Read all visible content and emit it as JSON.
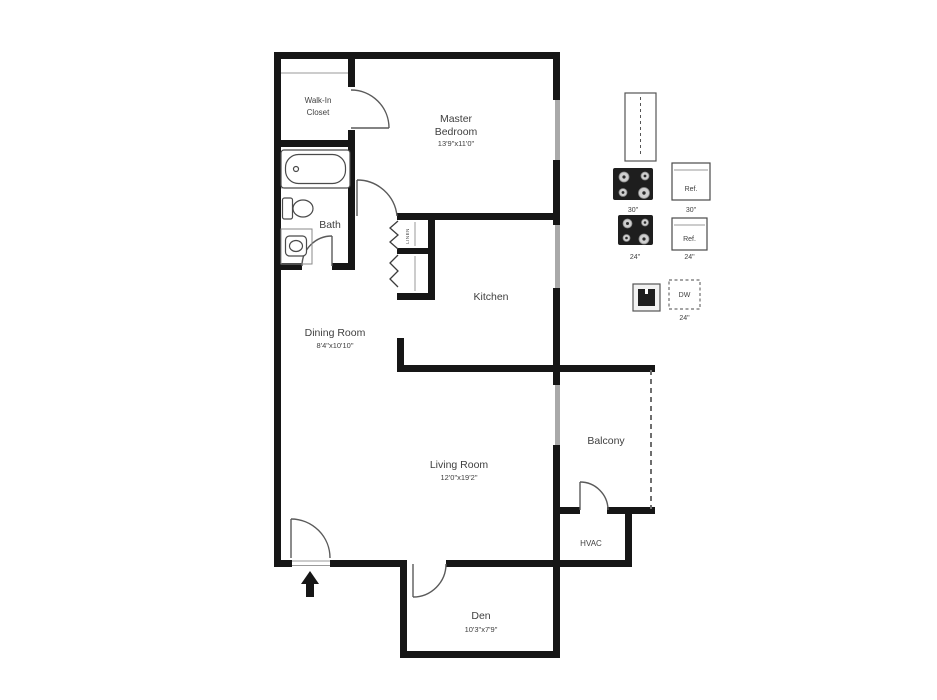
{
  "colors": {
    "wall": "#161616",
    "window": "#a9a9a9",
    "door": "#5a5a5a",
    "fixture": "#4a4a4a",
    "text": "#3f3f3f",
    "appliance_dark": "#1e1e1e",
    "dashed": "#6e6e6e"
  },
  "rooms": {
    "walk_in_closet": {
      "label_line1": "Walk-In",
      "label_line2": "Closet"
    },
    "master_bedroom": {
      "label_line1": "Master",
      "label_line2": "Bedroom",
      "dims": "13'9\"x11'0\""
    },
    "bath": {
      "label": "Bath"
    },
    "linen_closet": {
      "label": "LINEN"
    },
    "kitchen": {
      "label": "Kitchen"
    },
    "dining_room": {
      "label": "Dining Room",
      "dims": "8'4\"x10'10\""
    },
    "living_room": {
      "label": "Living Room",
      "dims": "12'0\"x19'2\""
    },
    "balcony": {
      "label": "Balcony"
    },
    "hvac": {
      "label": "HVAC"
    },
    "den": {
      "label": "Den",
      "dims": "10'3\"x7'9\""
    }
  },
  "legend": {
    "range_30": {
      "size": "30\""
    },
    "fridge_30": {
      "label": "Ref.",
      "size": "30\""
    },
    "range_24": {
      "size": "24\""
    },
    "fridge_24": {
      "label": "Ref.",
      "size": "24\""
    },
    "dishwasher": {
      "label": "DW",
      "size": "24\""
    }
  }
}
